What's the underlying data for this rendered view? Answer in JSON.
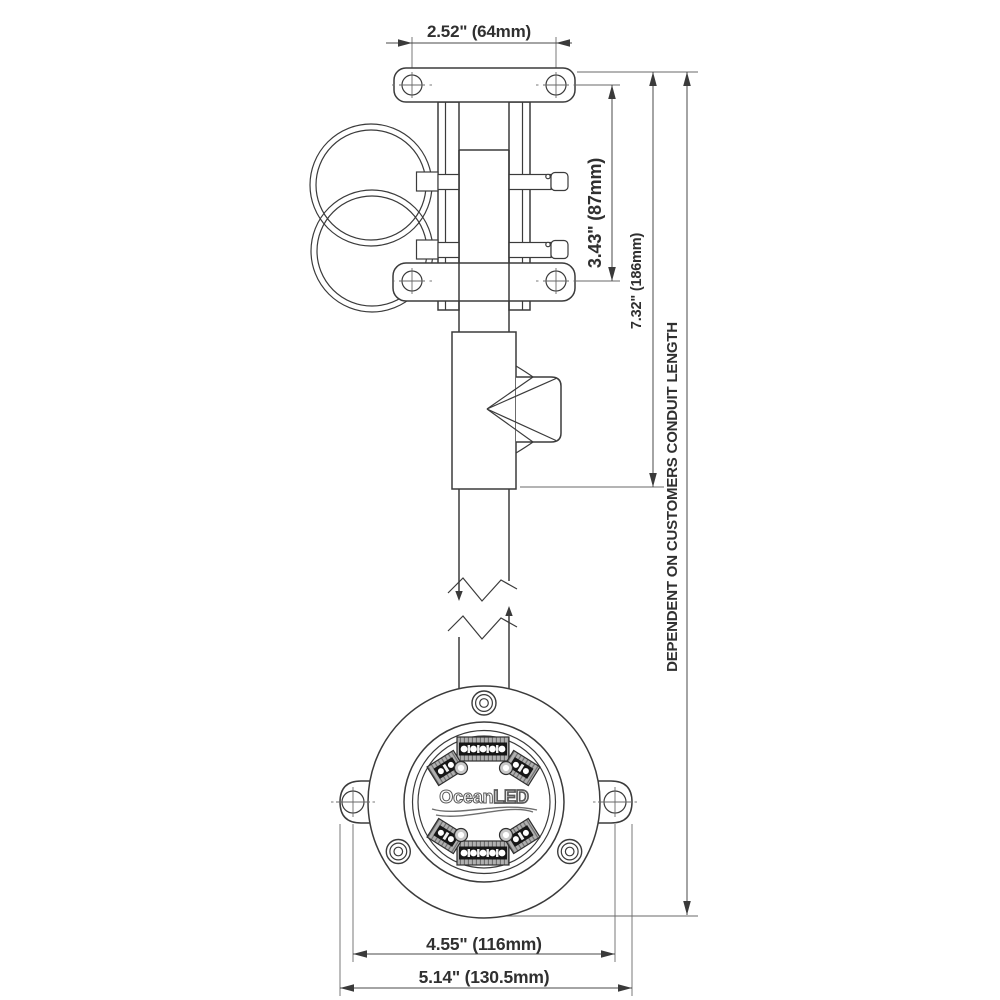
{
  "drawing": {
    "brand": {
      "ocean": "Ocean",
      "led": "LED"
    },
    "dimensions": {
      "top_width": "2.52\" (64mm)",
      "clamp_spacing": "3.43\" (87mm)",
      "assembly_height": "7.32\" (186mm)",
      "conduit_note": "DEPENDENT ON CUSTOMERS CONDUIT LENGTH",
      "bolt_spacing": "4.55\" (116mm)",
      "flange_width": "5.14\" (130.5mm)"
    },
    "colors": {
      "line": "#3b3b3b",
      "dim_line": "#4a4a4a",
      "text": "#303030",
      "module_dark": "#161616",
      "module_gray": "#a8a8a8",
      "background": "#ffffff"
    }
  }
}
